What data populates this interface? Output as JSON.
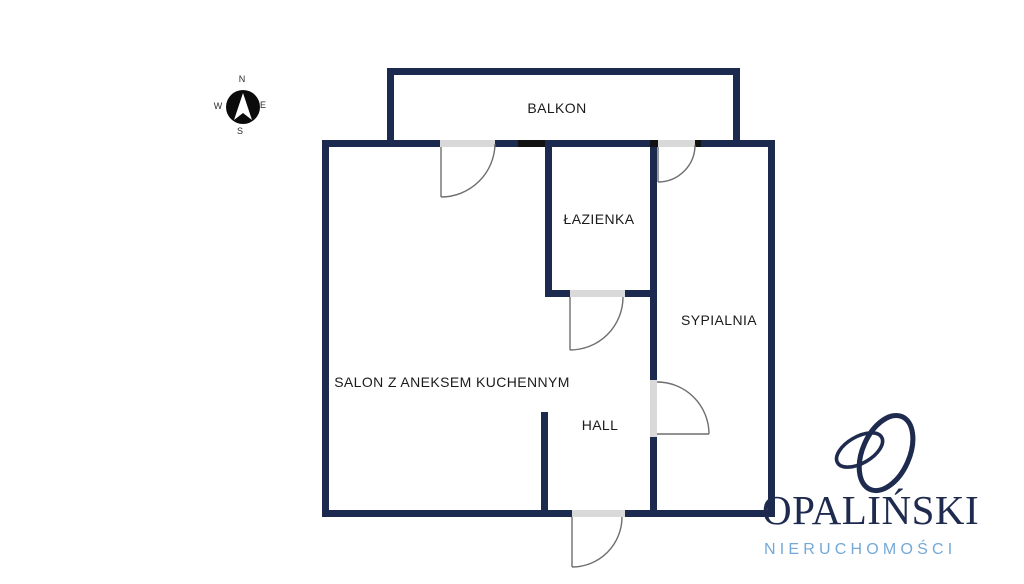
{
  "compass": {
    "north": "N",
    "east": "E",
    "south": "S",
    "west": "W"
  },
  "rooms": {
    "balkon": {
      "label": "BALKON"
    },
    "lazienka": {
      "label": "ŁAZIENKA"
    },
    "sypialnia": {
      "label": "SYPIALNIA"
    },
    "salon": {
      "label": "SALON Z ANEKSEM KUCHENNYM"
    },
    "hall": {
      "label": "HALL"
    }
  },
  "logo": {
    "name": "OPALIŃSKI",
    "tagline": "NIERUCHOMOŚCI"
  },
  "colors": {
    "wall": "#1c2a50",
    "opening": "#d9d9d9",
    "jamb": "#121212",
    "door": "#6e6e6e",
    "label": "#1b1b1b",
    "logo_navy": "#1f2b4e",
    "logo_blue": "#73a9d8"
  }
}
